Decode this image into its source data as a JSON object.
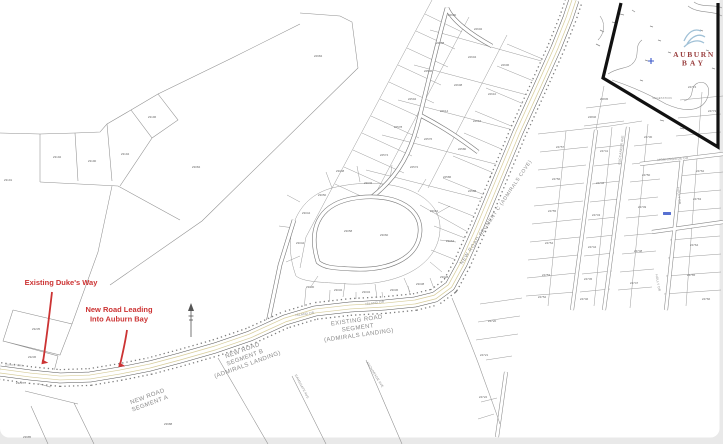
{
  "page": {
    "background": "#e9e9e9",
    "card_background": "#ffffff"
  },
  "colors": {
    "annotation_red": "#cc3333",
    "logo_red": "#9a4040",
    "logo_blue": "#9fc0d6",
    "road_tan": "#d6cc9a",
    "parcel_line": "#8f8f8f",
    "label_gray": "#8a8a8a",
    "lot_gray": "#6a6a6a",
    "boundary_black": "#111111",
    "highlight_blue": "#3a57c9"
  },
  "logo": {
    "line1": "AUBURN",
    "line2": "BAY"
  },
  "annotations": {
    "color": "#cc3333",
    "items": [
      {
        "lines": [
          "Existing Duke's Way"
        ],
        "x": 61,
        "y": 285,
        "size": 7.5
      },
      {
        "lines": [
          "New Road Leading",
          "Into Auburn Bay"
        ],
        "x": 119,
        "y": 312,
        "size": 7.5
      }
    ]
  },
  "map_labels": [
    {
      "lines": [
        "NEW ROAD SEGMENT C (ADMIRALS COVE)"
      ],
      "x": 497,
      "y": 213,
      "rot": -56,
      "size": 5,
      "ls": 0.6
    },
    {
      "lines": [
        "EXISTING ROAD",
        "SEGMENT",
        "(ADMIRALS LANDING)"
      ],
      "x": 357,
      "y": 322,
      "rot": -8,
      "size": 6,
      "ls": 0.4
    },
    {
      "lines": [
        "NEW ROAD",
        "SEGMENT B",
        "(ADMIRALS LANDING)"
      ],
      "x": 243,
      "y": 352,
      "rot": -20,
      "size": 6,
      "ls": 0.4
    },
    {
      "lines": [
        "NEW ROAD",
        "SEGMENT A"
      ],
      "x": 148,
      "y": 398,
      "rot": -20,
      "size": 6,
      "ls": 0.4
    },
    {
      "lines": [
        "ISLAND DR"
      ],
      "x": 305,
      "y": 315,
      "rot": -8,
      "size": 3.2,
      "ls": 0.2
    },
    {
      "lines": [
        "ISLAND DR"
      ],
      "x": 375,
      "y": 304,
      "rot": -8,
      "size": 3.2,
      "ls": 0.2
    },
    {
      "lines": [
        "MORNINGSIDE DR"
      ],
      "x": 673,
      "y": 160,
      "rot": -4,
      "size": 3.2,
      "ls": 0.2
    },
    {
      "lines": [
        "HOLLY DR"
      ],
      "x": 678,
      "y": 196,
      "rot": 84,
      "size": 3.2,
      "ls": 0.2
    },
    {
      "lines": [
        "HOLLY DR"
      ],
      "x": 657,
      "y": 283,
      "rot": 80,
      "size": 3.2,
      "ls": 0.2
    },
    {
      "lines": [
        "BUCCANEER AVE"
      ],
      "x": 622,
      "y": 150,
      "rot": -83,
      "size": 3.2,
      "ls": 0.2
    },
    {
      "lines": [
        "RAMSGATE AVE"
      ],
      "x": 301,
      "y": 387,
      "rot": 62,
      "size": 3.2,
      "ls": 0.2
    },
    {
      "lines": [
        "ANCHORAGE AVE"
      ],
      "x": 374,
      "y": 375,
      "rot": 58,
      "size": 3.2,
      "ls": 0.2
    },
    {
      "lines": [
        "DUKES WAY"
      ],
      "x": 14,
      "y": 366,
      "rot": 4,
      "size": 2.8,
      "ls": 0.2
    },
    {
      "lines": [
        "VEGETATION"
      ],
      "x": 662,
      "y": 99,
      "rot": 0,
      "size": 2.8,
      "ls": 0.2
    }
  ],
  "lot_numbers": {
    "top_left": [
      {
        "t": "23192",
        "x": 57,
        "y": 158
      },
      {
        "t": "23190",
        "x": 92,
        "y": 162
      },
      {
        "t": "23194",
        "x": 125,
        "y": 155
      },
      {
        "t": "23196",
        "x": 152,
        "y": 118
      },
      {
        "t": "23191",
        "x": 8,
        "y": 181
      },
      {
        "t": "23084",
        "x": 196,
        "y": 168
      },
      {
        "t": "22984",
        "x": 318,
        "y": 57
      }
    ],
    "bottom_left": [
      {
        "t": "23235",
        "x": 36,
        "y": 330
      },
      {
        "t": "23236",
        "x": 32,
        "y": 358
      },
      {
        "t": "23237",
        "x": 20,
        "y": 384
      },
      {
        "t": "23985",
        "x": 27,
        "y": 438
      },
      {
        "t": "23988",
        "x": 168,
        "y": 425
      }
    ],
    "central": [
      {
        "t": "22600",
        "x": 452,
        "y": 16
      },
      {
        "t": "22602",
        "x": 478,
        "y": 30
      },
      {
        "t": "22598",
        "x": 440,
        "y": 44
      },
      {
        "t": "22604",
        "x": 472,
        "y": 58
      },
      {
        "t": "22606",
        "x": 505,
        "y": 66
      },
      {
        "t": "22596",
        "x": 428,
        "y": 72
      },
      {
        "t": "22608",
        "x": 458,
        "y": 86
      },
      {
        "t": "22610",
        "x": 492,
        "y": 95
      },
      {
        "t": "22594",
        "x": 412,
        "y": 100
      },
      {
        "t": "22614",
        "x": 444,
        "y": 112
      },
      {
        "t": "22616",
        "x": 477,
        "y": 122
      },
      {
        "t": "22578",
        "x": 398,
        "y": 128
      },
      {
        "t": "22576",
        "x": 428,
        "y": 140
      },
      {
        "t": "22580",
        "x": 462,
        "y": 150
      },
      {
        "t": "22574",
        "x": 384,
        "y": 156
      },
      {
        "t": "22572",
        "x": 414,
        "y": 168
      },
      {
        "t": "22586",
        "x": 447,
        "y": 178
      },
      {
        "t": "22588",
        "x": 472,
        "y": 192
      },
      {
        "t": "23046",
        "x": 368,
        "y": 184
      },
      {
        "t": "23048",
        "x": 340,
        "y": 172
      },
      {
        "t": "23050",
        "x": 322,
        "y": 196
      },
      {
        "t": "23044",
        "x": 306,
        "y": 214
      },
      {
        "t": "23062",
        "x": 434,
        "y": 212
      },
      {
        "t": "23064",
        "x": 450,
        "y": 242
      },
      {
        "t": "23042",
        "x": 300,
        "y": 244
      },
      {
        "t": "23058",
        "x": 348,
        "y": 232
      },
      {
        "t": "23060",
        "x": 384,
        "y": 236
      },
      {
        "t": "23030",
        "x": 310,
        "y": 288
      },
      {
        "t": "23032",
        "x": 338,
        "y": 291
      },
      {
        "t": "23034",
        "x": 366,
        "y": 293
      },
      {
        "t": "23036",
        "x": 394,
        "y": 291
      },
      {
        "t": "23038",
        "x": 420,
        "y": 285
      },
      {
        "t": "23028",
        "x": 444,
        "y": 278
      }
    ],
    "right_grid": [
      {
        "t": "24757",
        "x": 560,
        "y": 148
      },
      {
        "t": "24756",
        "x": 556,
        "y": 180
      },
      {
        "t": "24755",
        "x": 552,
        "y": 212
      },
      {
        "t": "24754",
        "x": 549,
        "y": 244
      },
      {
        "t": "24753",
        "x": 546,
        "y": 276
      },
      {
        "t": "24752",
        "x": 542,
        "y": 298
      },
      {
        "t": "24741",
        "x": 604,
        "y": 152
      },
      {
        "t": "24742",
        "x": 600,
        "y": 184
      },
      {
        "t": "24743",
        "x": 596,
        "y": 216
      },
      {
        "t": "24744",
        "x": 592,
        "y": 248
      },
      {
        "t": "24745",
        "x": 588,
        "y": 280
      },
      {
        "t": "24746",
        "x": 584,
        "y": 300
      },
      {
        "t": "24730",
        "x": 648,
        "y": 138
      },
      {
        "t": "24750",
        "x": 646,
        "y": 176
      },
      {
        "t": "24749",
        "x": 642,
        "y": 208
      },
      {
        "t": "24748",
        "x": 638,
        "y": 252
      },
      {
        "t": "24747",
        "x": 634,
        "y": 284
      },
      {
        "t": "24762",
        "x": 700,
        "y": 172
      },
      {
        "t": "24763",
        "x": 697,
        "y": 200
      },
      {
        "t": "24764",
        "x": 694,
        "y": 246
      },
      {
        "t": "24765",
        "x": 691,
        "y": 276
      },
      {
        "t": "24766",
        "x": 706,
        "y": 300
      },
      {
        "t": "24845",
        "x": 604,
        "y": 100
      },
      {
        "t": "24846",
        "x": 592,
        "y": 118
      },
      {
        "t": "24774",
        "x": 692,
        "y": 88
      },
      {
        "t": "24773",
        "x": 712,
        "y": 112
      },
      {
        "t": "24720",
        "x": 492,
        "y": 322
      },
      {
        "t": "24721",
        "x": 484,
        "y": 356
      },
      {
        "t": "24722",
        "x": 483,
        "y": 398
      }
    ]
  }
}
